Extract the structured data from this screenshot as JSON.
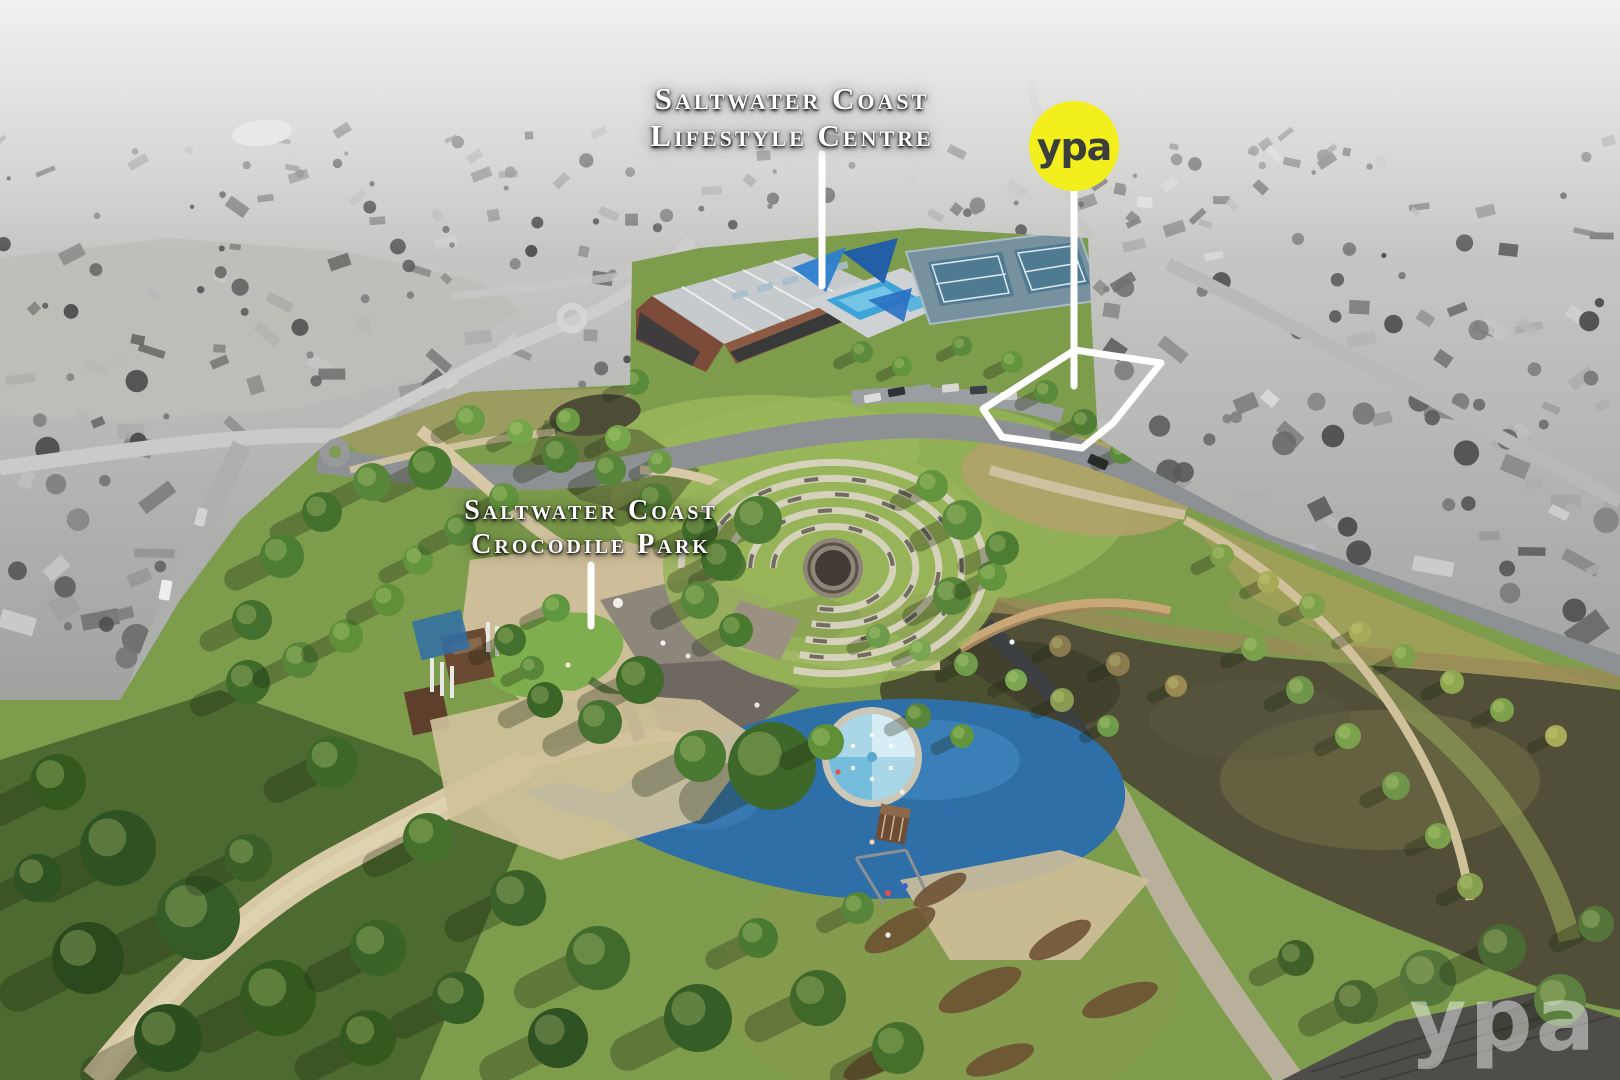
{
  "annotations": {
    "lifestyle_label": {
      "line1": "Saltwater Coast",
      "line2": "Lifestyle Centre"
    },
    "crocodile_label": {
      "line1": "Saltwater Coast",
      "line2": "Crocodile Park"
    },
    "label_color": "#ffffff"
  },
  "branding": {
    "logo_text": "ypa",
    "logo_bg": "#f2ef1d",
    "logo_fg": "#3a3f3c",
    "watermark_text": "ypa",
    "watermark_color": "#ffffff",
    "watermark_opacity": "0.45"
  },
  "scene": {
    "outline_color": "#ffffff",
    "park_green": "#7d9c4c",
    "water": "#514f38",
    "playground_blue": "#2f6fa8",
    "pool_blue": "#3fa3d8",
    "suburb_gray": "#a8a8a6"
  }
}
